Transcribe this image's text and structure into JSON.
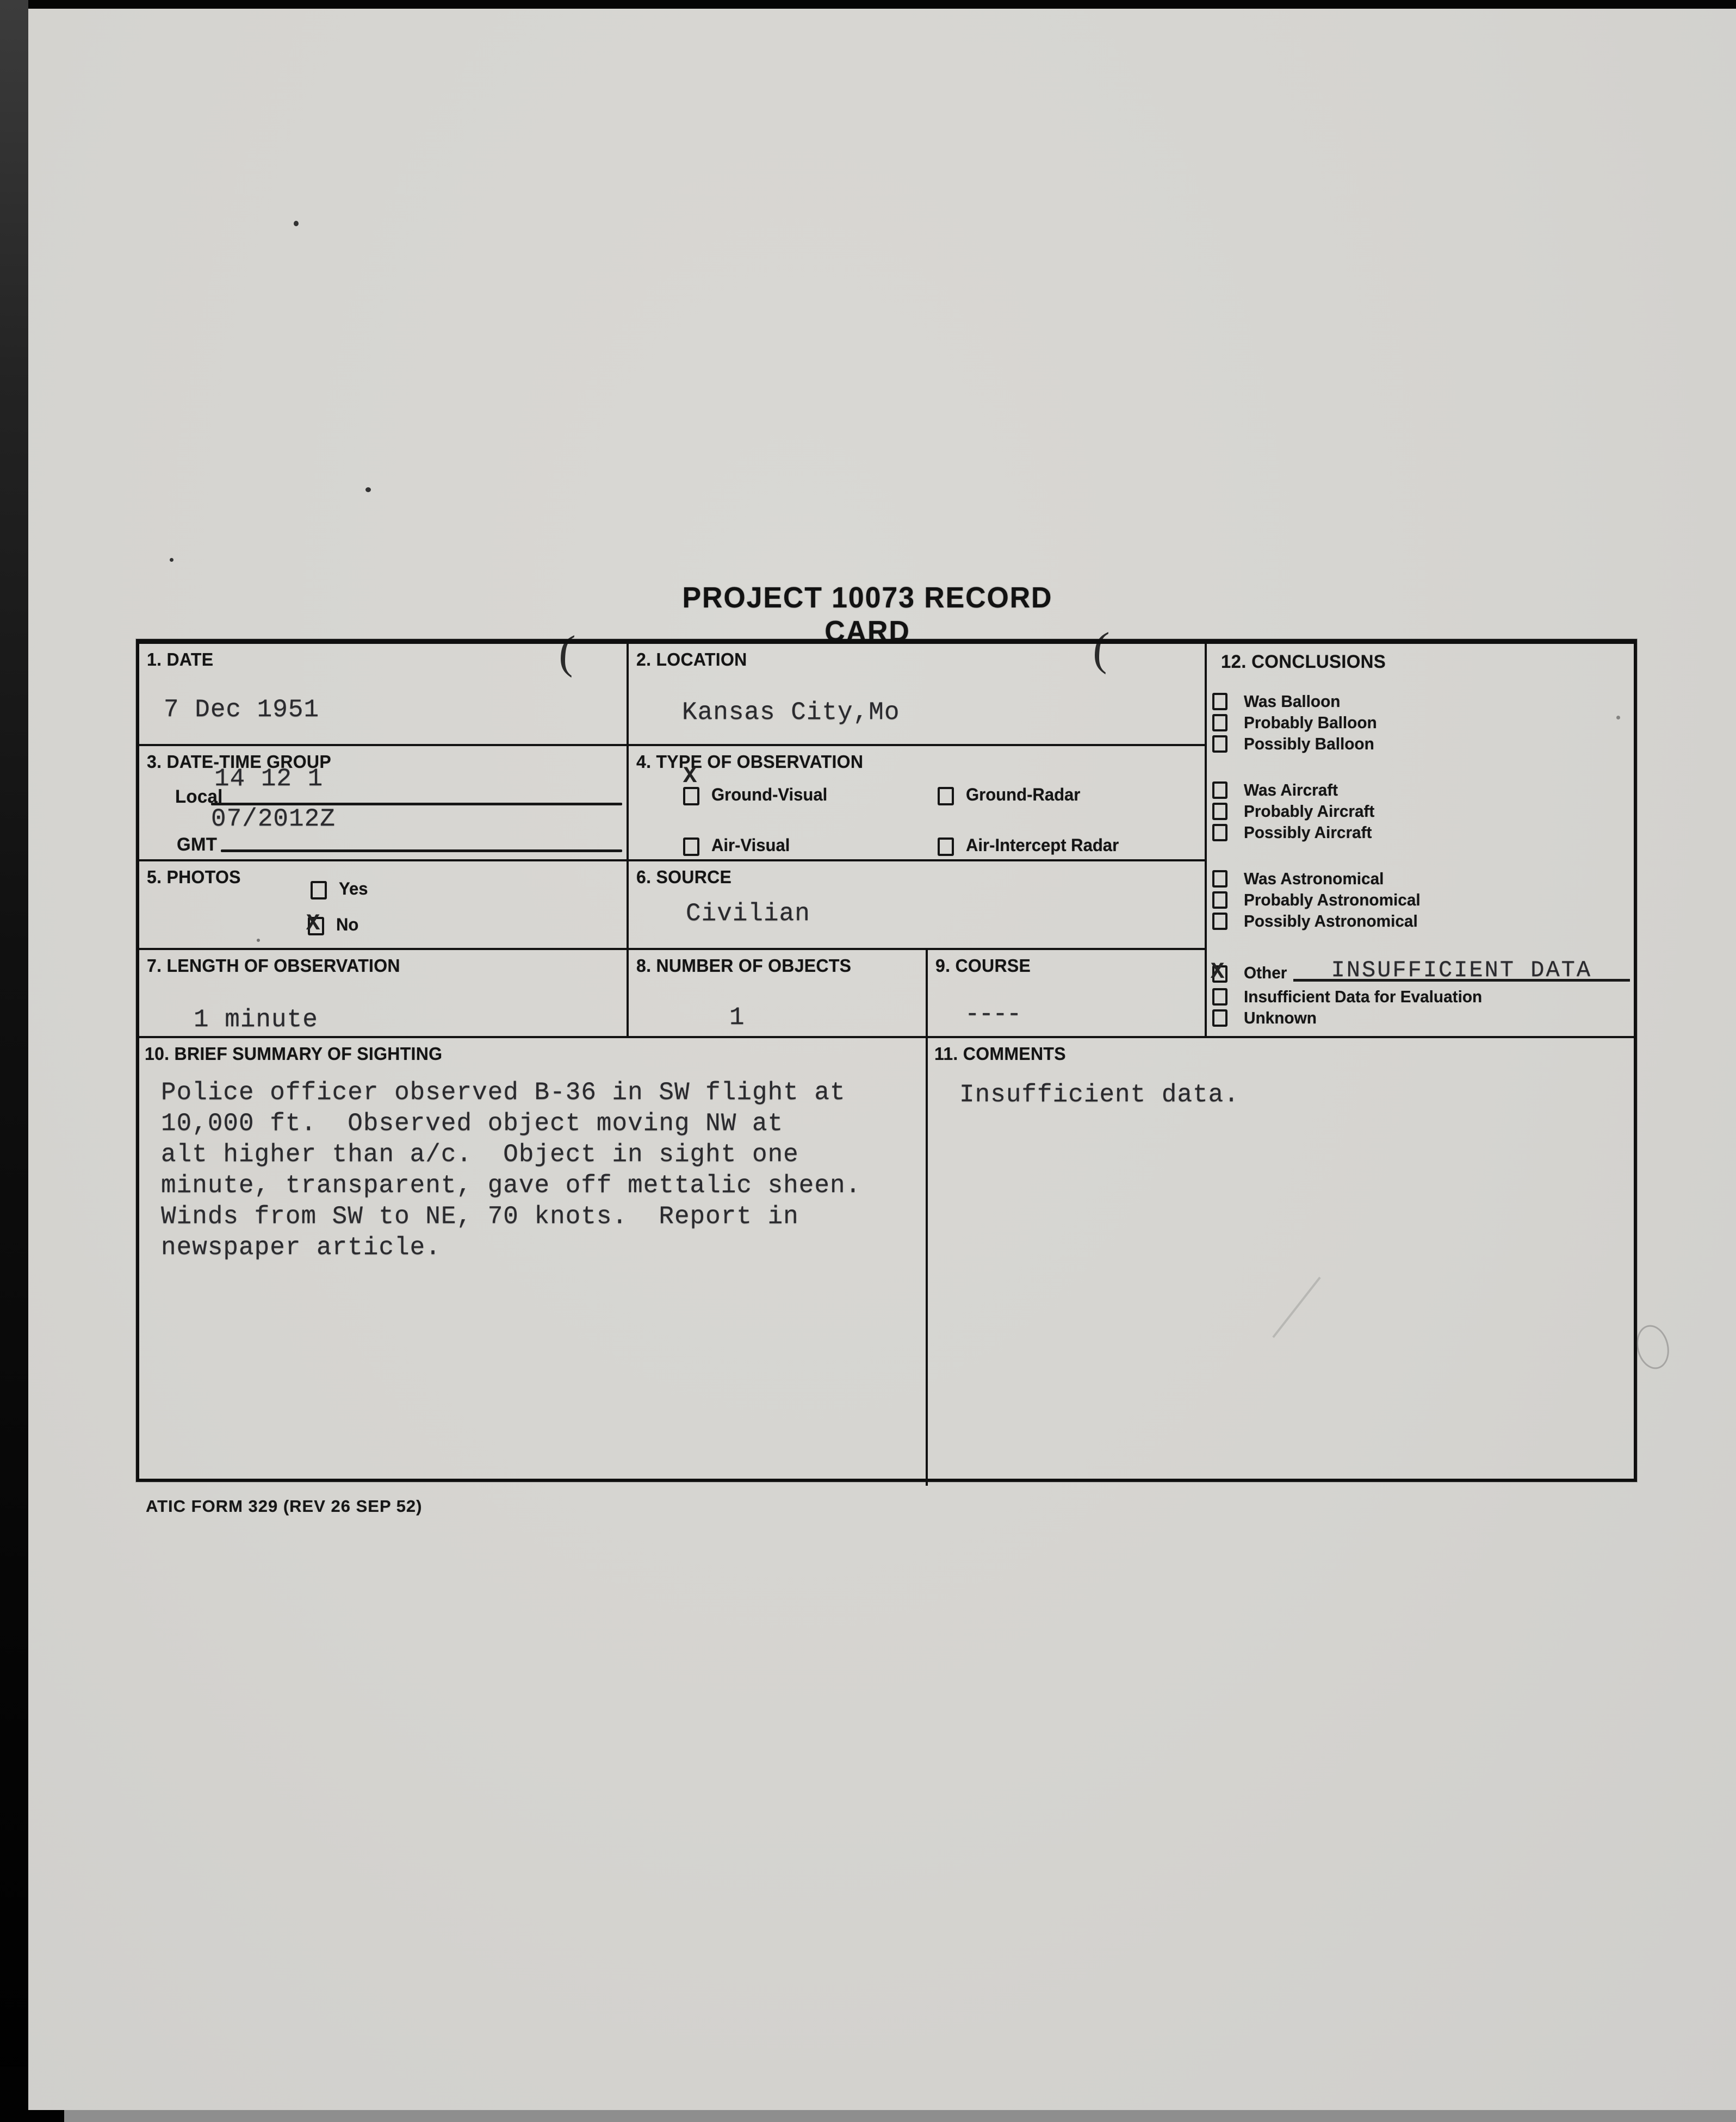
{
  "title": "PROJECT 10073 RECORD CARD",
  "footer": "ATIC FORM 329 (REV 26 SEP 52)",
  "colors": {
    "paper": "#d6d5d1",
    "ink": "#141414",
    "typed_ink": "#2a2a2e"
  },
  "artifacts": {
    "stray_mark_left": "(",
    "stray_mark_right": "("
  },
  "card": {
    "date": {
      "label": "1. DATE",
      "value": "7 Dec 1951"
    },
    "location": {
      "label": "2. LOCATION",
      "value": "Kansas City,Mo"
    },
    "datetime_group": {
      "label": "3. DATE-TIME GROUP",
      "local_label": "Local",
      "local_value": "14 12 1",
      "gmt_label": "GMT",
      "gmt_value": "07/2012Z"
    },
    "type_of_observation": {
      "label": "4. TYPE OF OBSERVATION",
      "options": [
        {
          "label": "Ground-Visual",
          "checked": true,
          "mark": "X"
        },
        {
          "label": "Ground-Radar",
          "checked": false,
          "mark": ""
        },
        {
          "label": "Air-Visual",
          "checked": false,
          "mark": ""
        },
        {
          "label": "Air-Intercept Radar",
          "checked": false,
          "mark": ""
        }
      ]
    },
    "photos": {
      "label": "5. PHOTOS",
      "options": [
        {
          "label": "Yes",
          "checked": false,
          "mark": ""
        },
        {
          "label": "No",
          "checked": true,
          "mark": "X"
        }
      ]
    },
    "source": {
      "label": "6. SOURCE",
      "value": "Civilian"
    },
    "length_of_observation": {
      "label": "7. LENGTH OF OBSERVATION",
      "value": "1 minute"
    },
    "number_of_objects": {
      "label": "8. NUMBER OF OBJECTS",
      "value": "1"
    },
    "course": {
      "label": "9. COURSE",
      "value": "----"
    },
    "brief_summary": {
      "label": "10. BRIEF SUMMARY OF SIGHTING",
      "text": "Police officer observed B-36 in SW flight at\n10,000 ft.  Observed object moving NW at\nalt higher than a/c.  Object in sight one\nminute, transparent, gave off mettalic sheen.\nWinds from SW to NE, 70 knots.  Report in\nnewspaper article."
    },
    "comments": {
      "label": "11. COMMENTS",
      "value": "Insufficient data."
    },
    "conclusions": {
      "label": "12. CONCLUSIONS",
      "items": [
        {
          "label": "Was Balloon",
          "checked": false,
          "mark": ""
        },
        {
          "label": "Probably Balloon",
          "checked": false,
          "mark": ""
        },
        {
          "label": "Possibly Balloon",
          "checked": false,
          "mark": ""
        },
        {
          "label": "Was Aircraft",
          "checked": false,
          "mark": ""
        },
        {
          "label": "Probably Aircraft",
          "checked": false,
          "mark": ""
        },
        {
          "label": "Possibly Aircraft",
          "checked": false,
          "mark": ""
        },
        {
          "label": "Was Astronomical",
          "checked": false,
          "mark": ""
        },
        {
          "label": "Probably Astronomical",
          "checked": false,
          "mark": ""
        },
        {
          "label": "Possibly Astronomical",
          "checked": false,
          "mark": ""
        },
        {
          "label": "Other",
          "checked": true,
          "mark": "X",
          "value": "INSUFFICIENT DATA"
        },
        {
          "label": "Insufficient Data for Evaluation",
          "checked": false,
          "mark": ""
        },
        {
          "label": "Unknown",
          "checked": false,
          "mark": ""
        }
      ]
    }
  }
}
